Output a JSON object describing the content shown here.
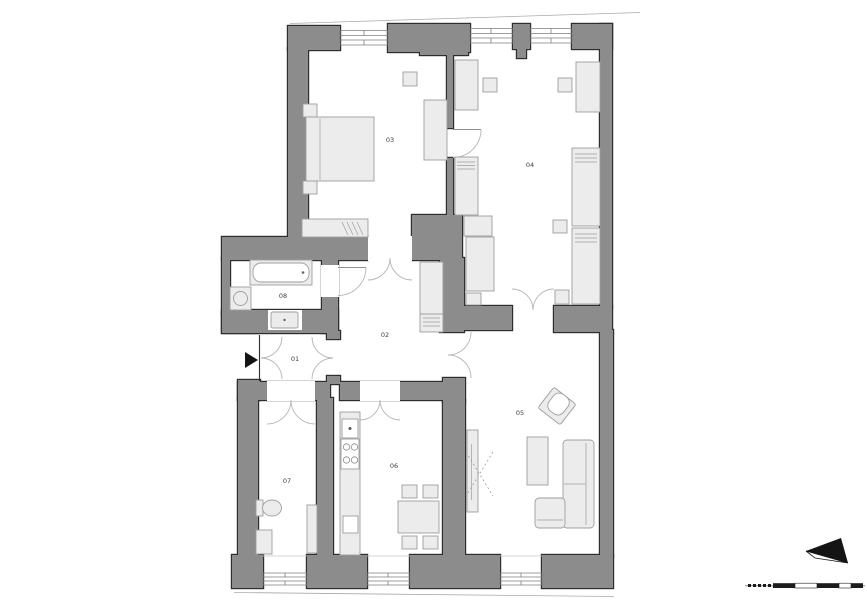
{
  "plan": {
    "rooms": [
      {
        "id": "room-01",
        "label": "01"
      },
      {
        "id": "room-02",
        "label": "02"
      },
      {
        "id": "room-03",
        "label": "03"
      },
      {
        "id": "room-04",
        "label": "04"
      },
      {
        "id": "room-05",
        "label": "05"
      },
      {
        "id": "room-06",
        "label": "06"
      },
      {
        "id": "room-07",
        "label": "07"
      },
      {
        "id": "room-08",
        "label": "08"
      }
    ],
    "colors": {
      "wall_fill": "#8c8c8c",
      "wall_outline": "#2e2e2e",
      "furniture_fill": "#ececec",
      "furniture_outline": "#9e9e9e",
      "door_arc": "#b5b5b5",
      "background": "#ffffff"
    },
    "symbols": [
      {
        "name": "entrance-arrow"
      },
      {
        "name": "north-arrow"
      },
      {
        "name": "scale-bar"
      }
    ]
  }
}
